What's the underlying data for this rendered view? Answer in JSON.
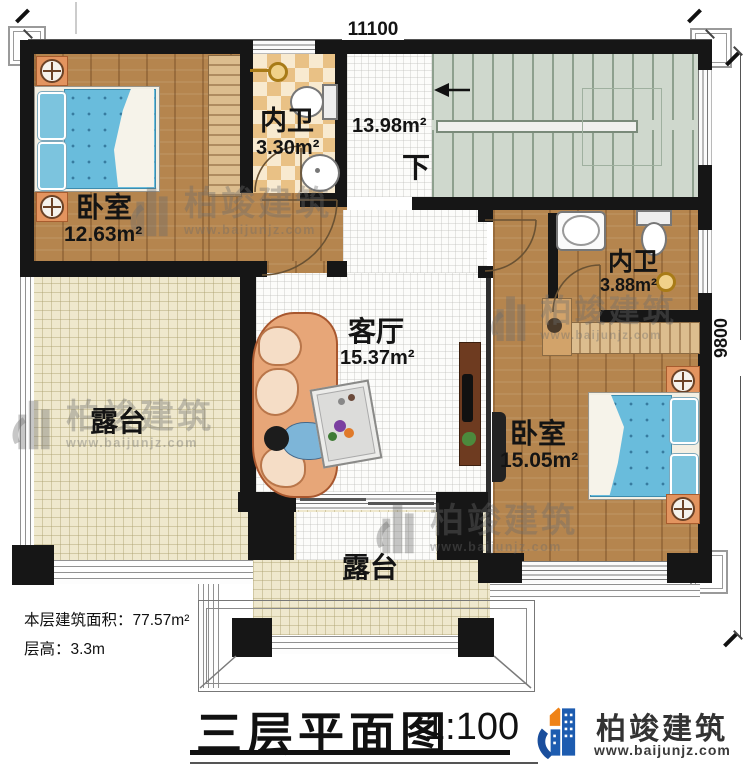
{
  "dimensions": {
    "top": "11100",
    "right": "9800"
  },
  "rooms": {
    "bedroom1": {
      "label": "卧室",
      "area": "12.63m²"
    },
    "bathroom1": {
      "label": "内卫",
      "area": "3.30m²"
    },
    "stair_hall": {
      "area": "13.98m²",
      "down_label": "下"
    },
    "bathroom2": {
      "label": "内卫",
      "area": "3.88m²"
    },
    "bedroom2": {
      "label": "卧室",
      "area": "15.05m²"
    },
    "living_room": {
      "label": "客厅",
      "area": "15.37m²"
    },
    "terrace_left": {
      "label": "露台"
    },
    "terrace_bottom": {
      "label": "露台"
    }
  },
  "notes": {
    "floor_area": "本层建筑面积：77.57m²",
    "floor_height": "层高：3.3m"
  },
  "title_block": {
    "title": "三层平面图",
    "scale": "1:100"
  },
  "brand": {
    "name": "柏竣建筑",
    "url": "www.baijunjz.com"
  },
  "colors": {
    "wall": "#161616",
    "wood_floor": "#b5854e",
    "bath_tile_dark": "#e9c185",
    "bath_tile_light": "#f8ead0",
    "stairs": "#cfd8cd",
    "terrace": "#efe8cd",
    "mattress": "#69bcdc",
    "sofa": "#e7a678",
    "logo_blue": "#1a4e9c",
    "logo_orange": "#ef8318"
  }
}
